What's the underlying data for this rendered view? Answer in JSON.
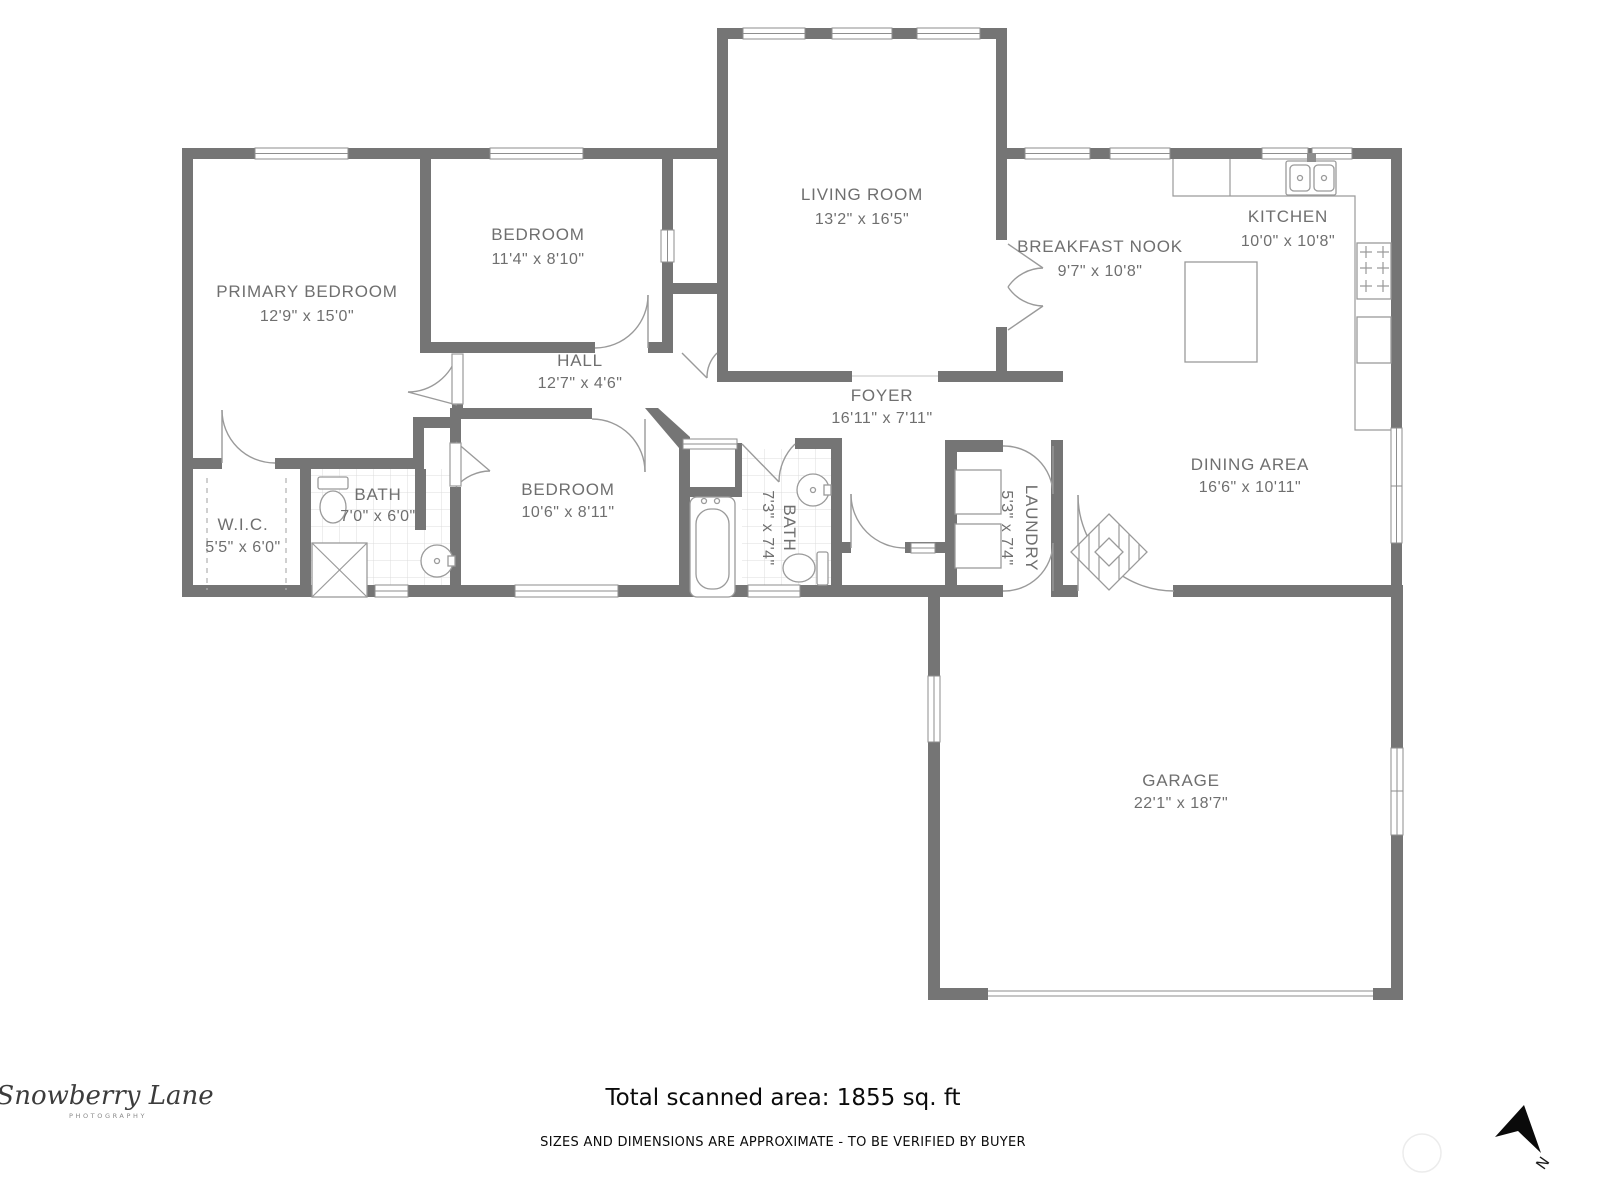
{
  "colors": {
    "wall": "#757575",
    "fixture": "#9a9a9a",
    "label": "#6f6f6f",
    "footer": "#0b0b0b"
  },
  "rooms": [
    {
      "id": "primary-bedroom",
      "name": "PRIMARY BEDROOM",
      "dims": "12'9\" x 15'0\""
    },
    {
      "id": "bedroom-2",
      "name": "BEDROOM",
      "dims": "11'4\" x 8'10\""
    },
    {
      "id": "living-room",
      "name": "LIVING ROOM",
      "dims": "13'2\" x 16'5\""
    },
    {
      "id": "breakfast-nook",
      "name": "BREAKFAST NOOK",
      "dims": "9'7\" x 10'8\""
    },
    {
      "id": "kitchen",
      "name": "KITCHEN",
      "dims": "10'0\" x 10'8\""
    },
    {
      "id": "hall",
      "name": "HALL",
      "dims": "12'7\" x 4'6\""
    },
    {
      "id": "foyer",
      "name": "FOYER",
      "dims": "16'11\" x 7'11\""
    },
    {
      "id": "wic",
      "name": "W.I.C.",
      "dims": "5'5\" x 6'0\""
    },
    {
      "id": "bath-1",
      "name": "BATH",
      "dims": "7'0\" x 6'0\""
    },
    {
      "id": "bedroom-3",
      "name": "BEDROOM",
      "dims": "10'6\" x 8'11\""
    },
    {
      "id": "bath-2",
      "name": "BATH",
      "dims": "7'3\" x 7'4\""
    },
    {
      "id": "laundry",
      "name": "LAUNDRY",
      "dims": "5'3\" x 7'4\""
    },
    {
      "id": "dining-area",
      "name": "DINING AREA",
      "dims": "16'6\" x 10'11\""
    },
    {
      "id": "garage",
      "name": "GARAGE",
      "dims": "22'1\" x 18'7\""
    }
  ],
  "footer": {
    "total_area": "Total scanned area: 1855 sq. ft",
    "disclaimer": "SIZES AND DIMENSIONS ARE APPROXIMATE - TO BE VERIFIED BY BUYER"
  },
  "branding": {
    "logo_script": "Snowberry Lane",
    "logo_sub": "PHOTOGRAPHY"
  },
  "compass": {
    "label": "N"
  }
}
